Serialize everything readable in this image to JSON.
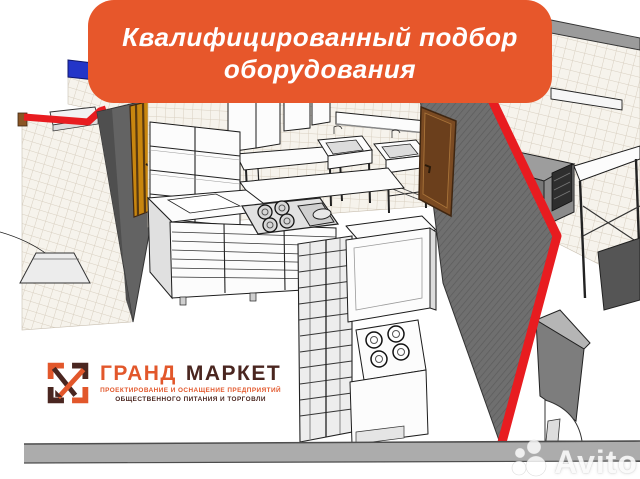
{
  "banner": {
    "line1": "Квалифицированный подбор",
    "line2": "оборудования"
  },
  "logo": {
    "icon": "grand-market-logo-mark",
    "title_part1": "ГРАНД",
    "title_part2": "МАРКЕТ",
    "tagline_line1": "ПРОЕКТИРОВАНИЕ И ОСНАЩЕНИЕ ПРЕДПРИЯТИЙ",
    "tagline_line2": "ОБЩЕСТВЕННОГО ПИТАНИЯ И ТОРГОВЛИ"
  },
  "watermark": {
    "brand": "Avito"
  },
  "scene": {
    "type": "3d-kitchen-design-render"
  },
  "colors": {
    "banner_bg": "#E7572B",
    "banner_text": "#FFFFFF",
    "logo_orange": "#E2572B",
    "logo_dark": "#4A2620",
    "section_red": "#E81C20",
    "stripe_blue": "#2335C8",
    "wall_gray": "#6F6F6F",
    "partition_gray": "#636363",
    "door_amber": "#C8860F",
    "door_brown": "#7A4A22",
    "tile_bg": "#F6F3EC",
    "tile_line": "#D8CFC0",
    "baseboard_gray": "#ACACAC",
    "equipment_outline": "#1C1C1C"
  }
}
